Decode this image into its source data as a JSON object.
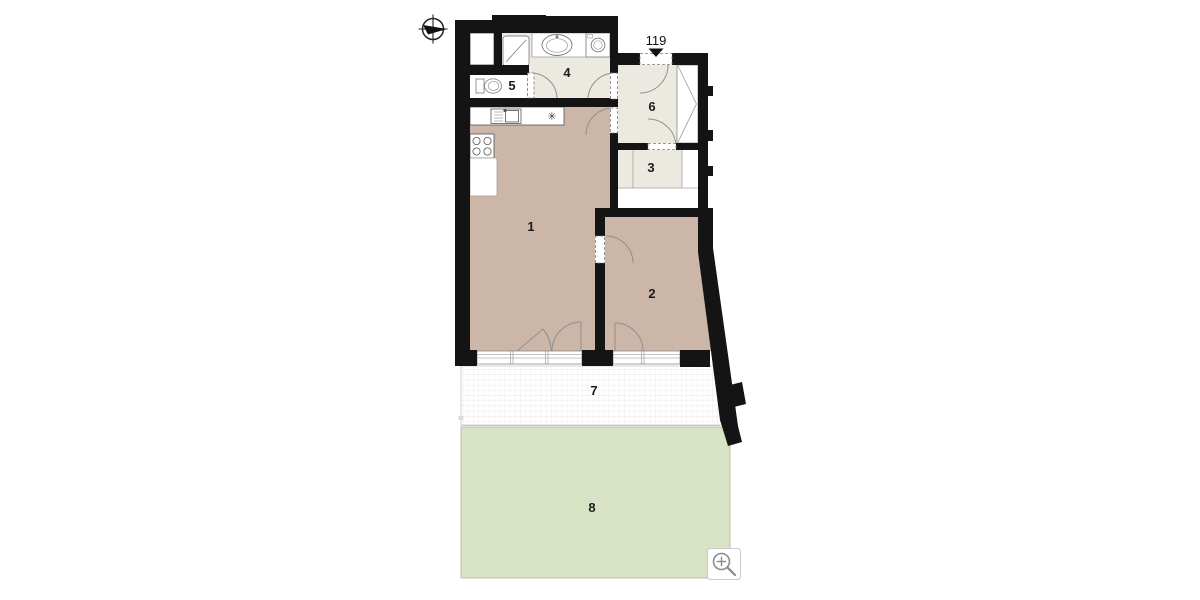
{
  "floor_plan": {
    "unit_number": "119",
    "labels": {
      "room1": "1",
      "room2": "2",
      "room3": "3",
      "room4": "4",
      "room5": "5",
      "room6": "6",
      "room7": "7",
      "room8": "8"
    },
    "kitchen_symbol": "✳",
    "colors": {
      "wall": "#141414",
      "residential_fill": "#ccb6a7",
      "service_fill": "#ece9e1",
      "garden_fill": "#d8e3c5",
      "terrace_grid_line": "#e3e3e3",
      "arc_line": "#8f8f8f"
    },
    "icons": {
      "compass": "compass-icon",
      "entrance": "entrance-arrow-icon",
      "zoom": "zoom-in-icon"
    }
  }
}
